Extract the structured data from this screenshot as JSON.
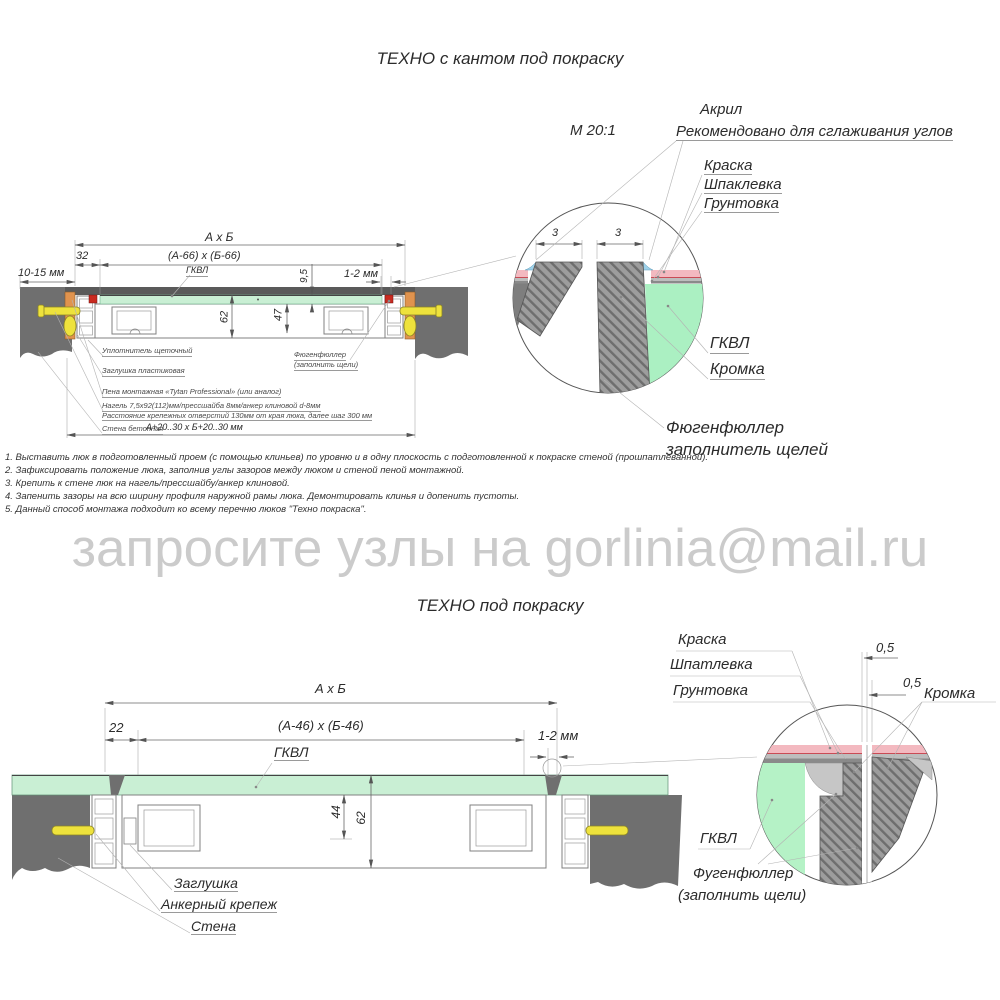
{
  "watermark": "запросите узлы на gorlinia@mail.ru",
  "top": {
    "title": "ТЕХНО с кантом под покраску",
    "dims": {
      "axb": "А х Б",
      "a66": "(А-66) х (Б-66)",
      "w32": "32",
      "w1015": "10-15 мм",
      "gkvl": "ГКВЛ",
      "t95": "9,5",
      "gap12": "1-2 мм",
      "h62": "62",
      "h47": "47",
      "bottom": "А+20..30 х Б+20..30 мм"
    },
    "callouts": [
      "Уплотнитель щеточный",
      "Заглушка пластиковая",
      "Пена монтажная «Tytan Professional» (или аналог)",
      "Нагель 7,5х92(112)мм/прессшайба 8мм/анкер клиновой d-8мм",
      "Расстояние крепежных отверстий 130мм от края люка, далее шаг 300 мм",
      "Стена бетонная"
    ],
    "filler_note_1": "Фюгенфюллер",
    "filler_note_2": "(заполнить щели)",
    "detail": {
      "scale": "М 20:1",
      "acryl": "Акрил",
      "acryl_note": "Рекомендовано для сглаживания углов",
      "paint": "Краска",
      "putty": "Шпаклевка",
      "primer": "Грунтовка",
      "gkvl": "ГКВЛ",
      "edge": "Кромка",
      "filler_1": "Фюгенфюллер",
      "filler_2": "заполнитель щелей",
      "gap3a": "3",
      "gap3b": "3"
    },
    "notes": [
      "1. Выставить люк в подготовленный проем (с помощью клиньев) по уровню и в одну плоскость с подготовленной к покраске стеной (прошпатлеванной).",
      "2. Зафиксировать положение люка, заполнив углы зазоров между люком и стеной пеной монтажной.",
      "3. Крепить к стене люк на нагель/прессшайбу/анкер клиновой.",
      "4. Запенить зазоры на всю ширину профиля наружной рамы люка. Демонтировать клинья и допенить пустоты.",
      "5. Данный способ монтажа подходит ко всему перечню люков \"Техно покраска\"."
    ]
  },
  "bottom": {
    "title": "ТЕХНО под покраску",
    "dims": {
      "axb": "А х Б",
      "a46": "(А-46) х (Б-46)",
      "w22": "22",
      "gkvl": "ГКВЛ",
      "gap12": "1-2 мм",
      "h44": "44",
      "h62": "62"
    },
    "callouts": [
      "Заглушка",
      "Анкерный крепеж",
      "Стена"
    ],
    "detail": {
      "paint": "Краска",
      "putty": "Шпатлевка",
      "primer": "Грунтовка",
      "g05a": "0,5",
      "g05b": "0,5",
      "edge": "Кромка",
      "gkvl": "ГКВЛ",
      "filler_1": "Фугенфюллер",
      "filler_2": "(заполнить щели)"
    }
  },
  "colors": {
    "wall": "#6f6f6f",
    "green_panel": "#c9efd4",
    "green_detail": "#b5f2c6",
    "orange": "#e0934e",
    "yellow": "#eee23c",
    "red_seal": "#c92a20",
    "pink_paint": "#f3b9c0",
    "acryl_blue": "#9fd2ea",
    "watermark_gray": "#cbcbcb"
  }
}
